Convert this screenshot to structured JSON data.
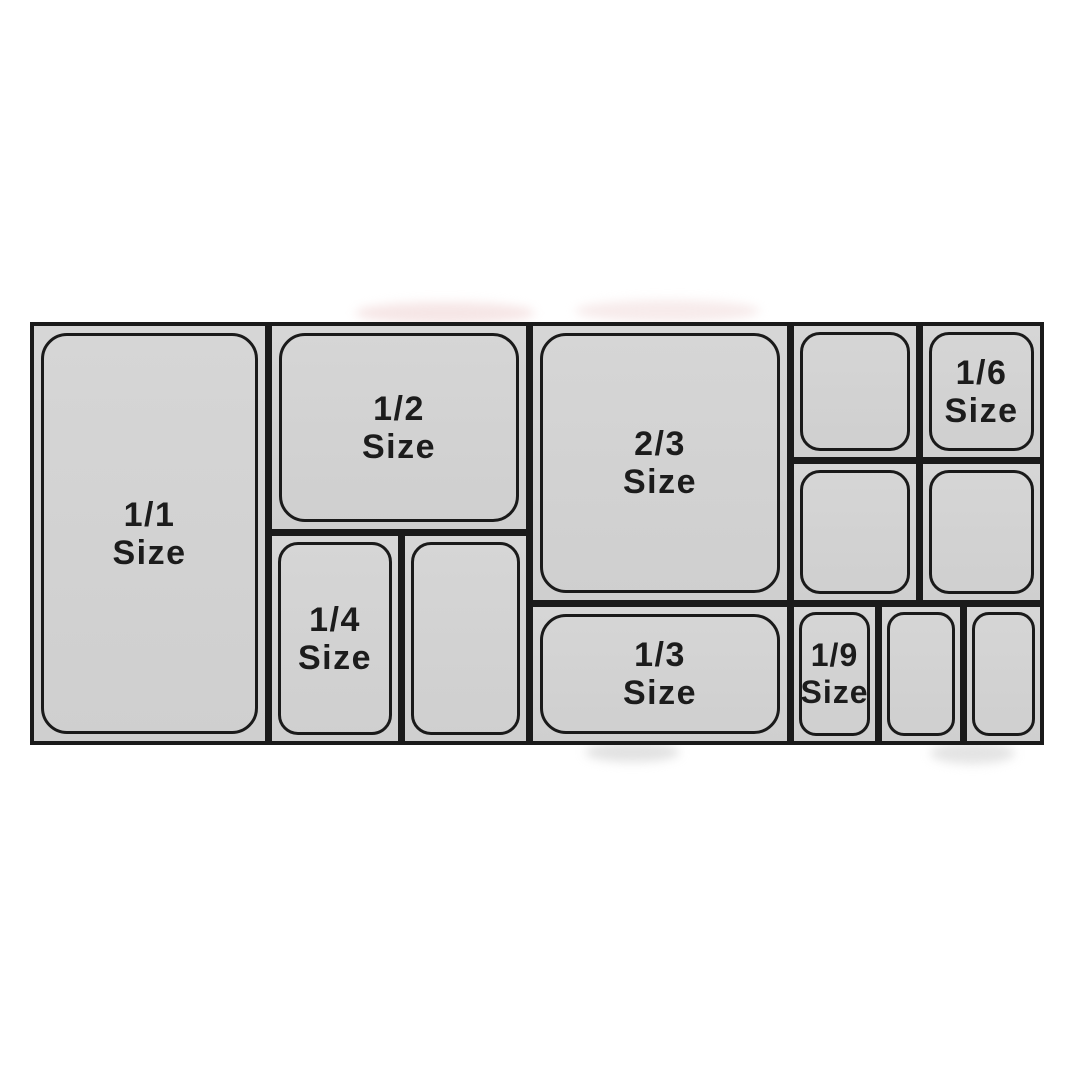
{
  "colors": {
    "page_bg": "#ffffff",
    "pan_fill": "#d2d2d2",
    "outline": "#1a1a1a",
    "label_text": "#1c1c1c"
  },
  "pans": {
    "full": {
      "fraction": "1/1",
      "word": "Size"
    },
    "half": {
      "fraction": "1/2",
      "word": "Size"
    },
    "two_thirds": {
      "fraction": "2/3",
      "word": "Size"
    },
    "third": {
      "fraction": "1/3",
      "word": "Size"
    },
    "quarter": {
      "fraction": "1/4",
      "word": "Size"
    },
    "sixth": {
      "fraction": "1/6",
      "word": "Size"
    },
    "ninth": {
      "fraction": "1/9",
      "word": "Size"
    }
  }
}
